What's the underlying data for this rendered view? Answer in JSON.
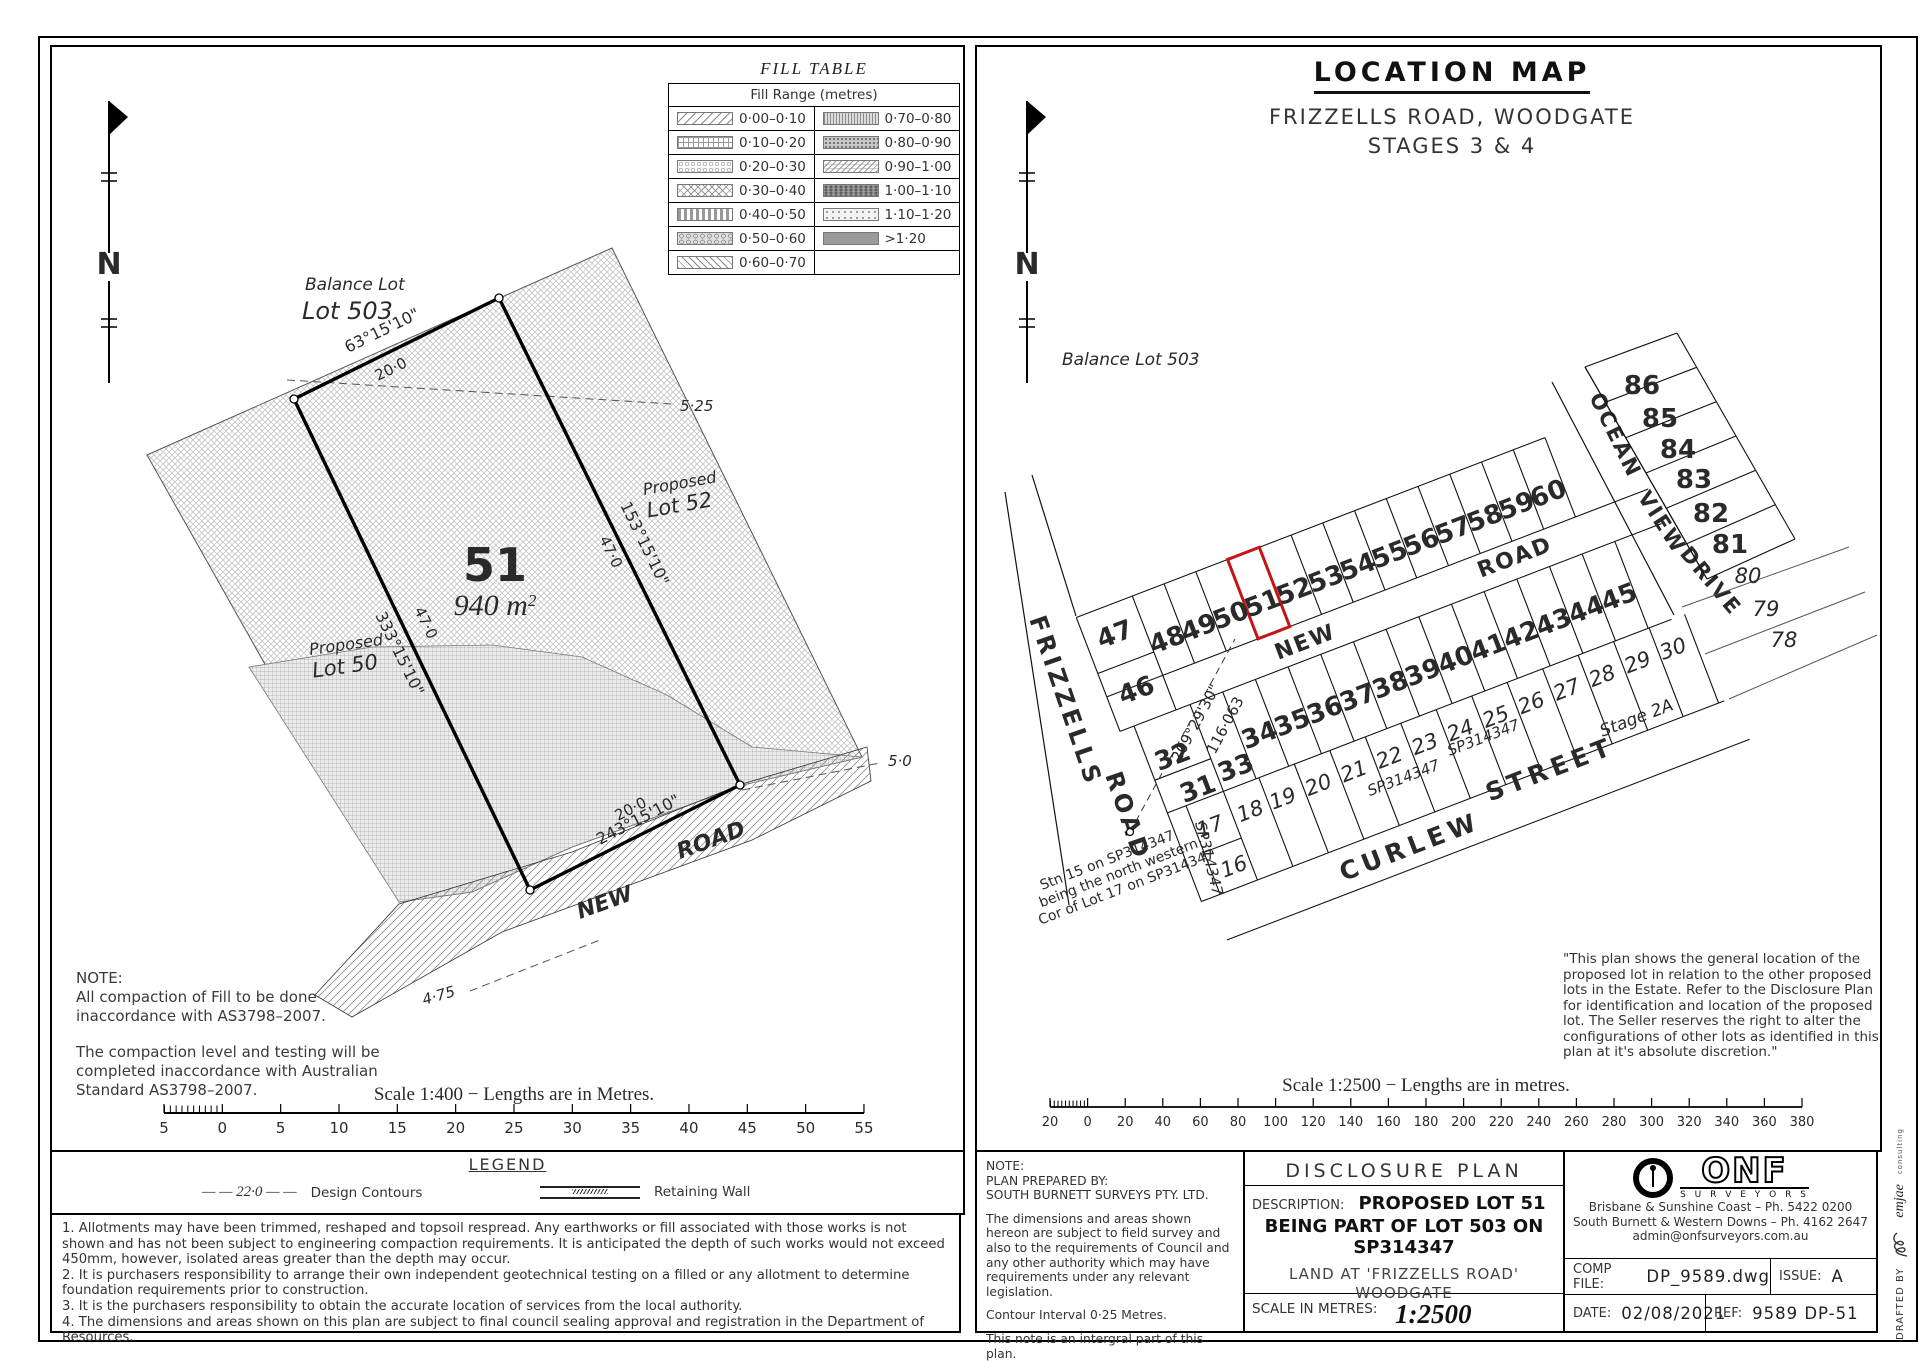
{
  "left": {
    "fill_table": {
      "title": "FILL TABLE",
      "header": "Fill Range (metres)",
      "left_rows": [
        "0·00–0·10",
        "0·10–0·20",
        "0·20–0·30",
        "0·30–0·40",
        "0·40–0·50",
        "0·50–0·60",
        "0·60–0·70"
      ],
      "right_rows": [
        "0·70–0·80",
        "0·80–0·90",
        "0·90–1·00",
        "1·00–1·10",
        "1·10–1·20",
        ">1·20"
      ]
    },
    "plan": {
      "north": "N",
      "balance_lot_line1": "Balance Lot",
      "balance_lot_line2": "Lot 503",
      "lot_number": "51",
      "area_value": "940 m",
      "area_sup": "2",
      "bearing_top": "63°15'10\"",
      "dist_top": "20·0",
      "bearing_right": "153°15'10\"",
      "dist_right": "47·0",
      "bearing_left": "333°15'10\"",
      "dist_left": "47·0",
      "bearing_bottom": "243°15'10\"",
      "dist_bottom": "20·0",
      "proposed_upper_line1": "Proposed",
      "proposed_upper_line2": "Lot 52",
      "proposed_lower_line1": "Proposed",
      "proposed_lower_line2": "Lot 50",
      "contour_525": "5·25",
      "contour_50": "5·0",
      "contour_475": "4·75",
      "road_word1": "NEW",
      "road_word2": "ROAD"
    },
    "note_title": "NOTE:",
    "note_p1": [
      "All compaction of Fill to be done",
      "inaccordance with AS3798–2007."
    ],
    "note_p2": [
      "The compaction level and testing will be",
      "completed inaccordance with Australian",
      "Standard AS3798–2007."
    ],
    "scale_text": "Scale 1:400 − Lengths are in Metres.",
    "scale_ticks": [
      "5",
      "0",
      "5",
      "10",
      "15",
      "20",
      "25",
      "30",
      "35",
      "40",
      "45",
      "50",
      "55"
    ]
  },
  "legend": {
    "title": "LEGEND",
    "contour_symbol": "— — 22·0 — —",
    "contour_label": "Design Contours",
    "wall_label": "Retaining Wall"
  },
  "notes": [
    "1. Allotments may have been trimmed, reshaped and topsoil respread. Any earthworks or fill associated with those works is not shown and has not been subject to engineering compaction requirements. It is anticipated the depth of such works would not exceed 450mm, however, isolated areas greater than the depth may occur.",
    "2. It is purchasers responsibility to arrange their own independent geotechnical testing on a filled or any allotment to determine foundation requirements prior to construction.",
    "3. It is the purchasers responsibility to obtain the accurate location of services from the local authority.",
    "4. The dimensions and areas shown on this plan are subject to final council sealing approval and registration in the Department of Resources."
  ],
  "right": {
    "header": {
      "title": "LOCATION MAP",
      "subtitle1": "FRIZZELLS ROAD, WOODGATE",
      "subtitle2": "STAGES 3 & 4"
    },
    "map": {
      "north": "N",
      "balance_lot": "Balance Lot 503",
      "frizzells": "FRIZZELLS",
      "frizzells_road": "ROAD",
      "new": "NEW",
      "new_road": "ROAD",
      "ocean": "OCEAN",
      "view": "VIEW",
      "drive": "DRIVE",
      "curlew": "CURLEW",
      "street": "STREET",
      "stage": "Stage 2A",
      "bearing": "209°29'30\"",
      "distance": "116·063",
      "sp1": "SP314347",
      "sp2": "SP314347",
      "sp3": "SP314347",
      "stn_line1": "Stn 15 on SP314347",
      "stn_line2": "being the north western",
      "stn_line3": "Cor of Lot 17 on SP314347",
      "top_lots": [
        "46",
        "47",
        "48",
        "49",
        "50",
        "51",
        "52",
        "53",
        "54",
        "55",
        "56",
        "57",
        "58",
        "59",
        "60"
      ],
      "mid_lots": [
        "31",
        "32",
        "33",
        "34",
        "35",
        "36",
        "37",
        "38",
        "39",
        "40",
        "41",
        "42",
        "43",
        "44",
        "45"
      ],
      "low_lots": [
        "16",
        "17",
        "18",
        "19",
        "20",
        "21",
        "22",
        "23",
        "24",
        "25",
        "26",
        "27",
        "28",
        "29",
        "30"
      ],
      "east_lots": [
        "81",
        "82",
        "83",
        "84",
        "85",
        "86"
      ],
      "east_italic": [
        "78",
        "79",
        "80"
      ]
    },
    "quote": [
      "\"This plan shows the general location of the",
      "proposed lot in relation to the other proposed",
      "lots in the Estate. Refer to the Disclosure Plan",
      "for identification and location of the proposed",
      "lot. The Seller reserves the right to alter the",
      "configurations of other lots as identified in this",
      "plan at it's absolute discretion.\""
    ],
    "scale_text": "Scale 1:2500 − Lengths are in metres.",
    "scale_ticks": [
      "20",
      "0",
      "20",
      "40",
      "60",
      "80",
      "100",
      "120",
      "140",
      "160",
      "180",
      "200",
      "220",
      "240",
      "260",
      "280",
      "300",
      "320",
      "340",
      "360",
      "380"
    ]
  },
  "title_block": {
    "note_title": "NOTE:",
    "prepared_line1": "PLAN PREPARED BY:",
    "prepared_line2": "SOUTH BURNETT SURVEYS PTY. LTD.",
    "body": "The dimensions and areas shown hereon are subject to field survey and also to the requirements of Council and any other authority which may have requirements under any relevant legislation.",
    "contour_note": "Contour Interval 0·25 Metres.",
    "integral_note": "This note is an intergral part of this plan.",
    "plan_title": "DISCLOSURE PLAN",
    "description_label": "DESCRIPTION:",
    "description_line1": "PROPOSED LOT 51",
    "description_line2": "BEING PART OF LOT 503 ON SP314347",
    "land_line1": "LAND AT 'FRIZZELLS ROAD'",
    "land_line2": "WOODGATE",
    "scale_label": "SCALE IN METRES:",
    "scale_value": "1:2500",
    "firm": {
      "name": "ONF",
      "sub": "S U R V E Y O R S",
      "addr1": "Brisbane & Sunshine Coast – Ph. 5422 0200",
      "addr2": "South Burnett & Western Downs – Ph. 4162 2647",
      "addr3": "admin@onfsurveyors.com.au"
    },
    "comp_label": "COMP FILE:",
    "comp_value": "DP_9589.dwg",
    "issue_label": "ISSUE:",
    "issue_value": "A",
    "date_label": "DATE:",
    "date_value": "02/08/2021",
    "ref_label": "REF:",
    "ref_value": "9589 DP-51",
    "drafted_by": "DRAFTED BY",
    "drafted_brand": "emjae",
    "drafted_sub": "consulting"
  }
}
